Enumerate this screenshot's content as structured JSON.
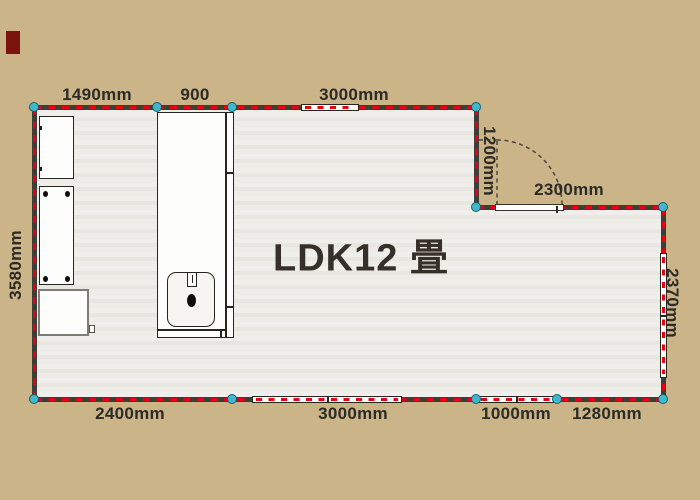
{
  "room": {
    "label": "LDK12 畳"
  },
  "dimensions": {
    "top_left": "1490mm",
    "top_mid": "900",
    "top_right": "3000mm",
    "notch_vertical": "1200mm",
    "notch_horizontal": "2300mm",
    "left_side": "3580mm",
    "right_side": "2370mm",
    "bottom_1": "2400mm",
    "bottom_2": "3000mm",
    "bottom_3": "1000mm",
    "bottom_4": "1280mm"
  },
  "fixtures": [
    "wall-cabinet",
    "tall-cabinet",
    "range-unit",
    "kitchen-sink-counter",
    "door-swing"
  ],
  "colors": {
    "background": "#cab488",
    "floor": "#ecebe6",
    "wall": "#3b3f3a",
    "wall_dash": "#e60012",
    "window": "#ffffff",
    "node_fill": "#41b7cb",
    "node_ring": "#15606f",
    "text": "#2c2b26",
    "room_label_text": "#37302a",
    "accent_square": "#7a150d"
  }
}
